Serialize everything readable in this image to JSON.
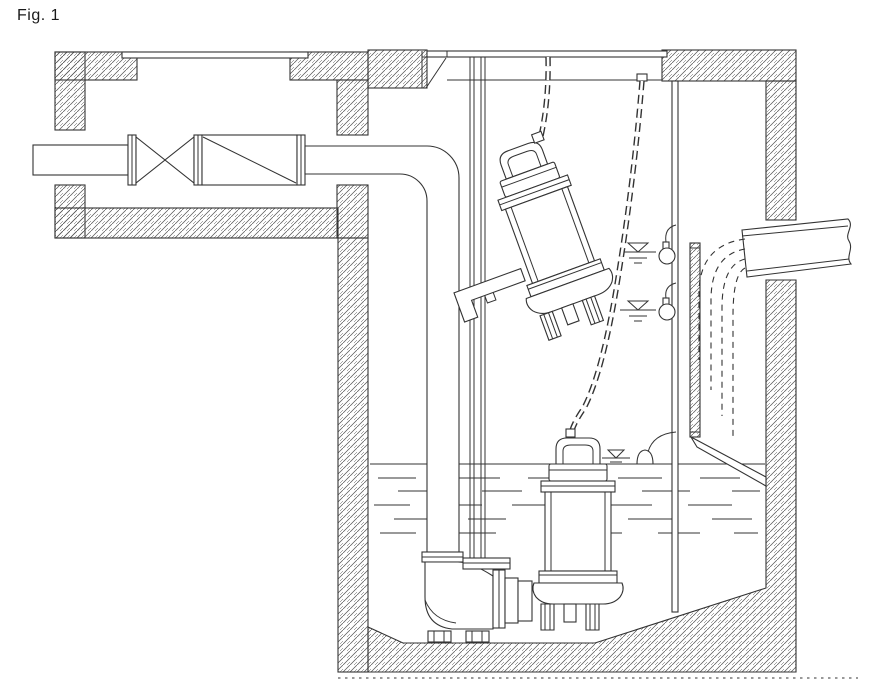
{
  "figure": {
    "label": "Fig. 1"
  },
  "colors": {
    "line": "#333333",
    "hatch": "#555555",
    "background": "#ffffff"
  },
  "diagram": {
    "type": "technical-line-drawing",
    "components": [
      "valve-chamber",
      "chamber-access-cover",
      "inlet-pipe",
      "gate-valve",
      "check-valve",
      "discharge-pipe",
      "discharge-elbow",
      "riser-pipe",
      "riser-flange",
      "duckfoot-bend",
      "guide-rails",
      "rail-base-plate",
      "installed-pump",
      "suspended-pump",
      "guide-claw-bracket",
      "lifting-chain-front",
      "lifting-chain-rear",
      "chain-anchor",
      "chain-hook",
      "wet-well",
      "pit-access-cover",
      "hatch-edge-bracket",
      "water-surface",
      "water-level-marker-high",
      "water-level-marker-low",
      "water-level-marker-surface",
      "float-switch-upper",
      "float-switch-lower",
      "float-switch-floating",
      "float-cable-conduit",
      "baffle-plate",
      "deflector-plate",
      "inflow-pipe",
      "inflow-streamlines",
      "ground-line"
    ],
    "counts": {
      "pumps": 2,
      "float_switches": 3,
      "water_level_markers": 3,
      "lifting_chains": 2
    }
  }
}
